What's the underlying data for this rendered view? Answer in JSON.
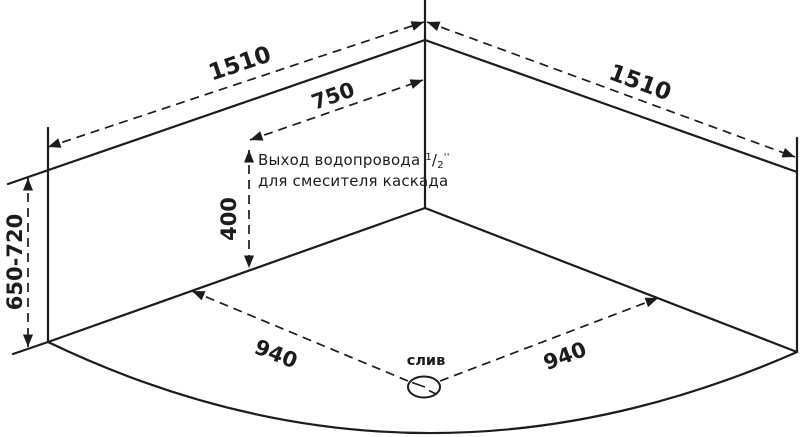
{
  "diagram": {
    "dims": {
      "top_left_edge": "1510",
      "top_right_edge": "1510",
      "outlet_offset": "750",
      "outlet_height": "400",
      "install_height": "650-720",
      "floor_left": "940",
      "floor_right": "940"
    },
    "labels": {
      "drain": "слив",
      "outlet_line1": "Выход водопровода",
      "outlet_frac_num": "1",
      "outlet_frac_den": "2",
      "outlet_unit": "''",
      "outlet_line2": "для смесителя каскада"
    },
    "colors": {
      "line": "#1c1c1c",
      "background": "#ffffff"
    }
  }
}
